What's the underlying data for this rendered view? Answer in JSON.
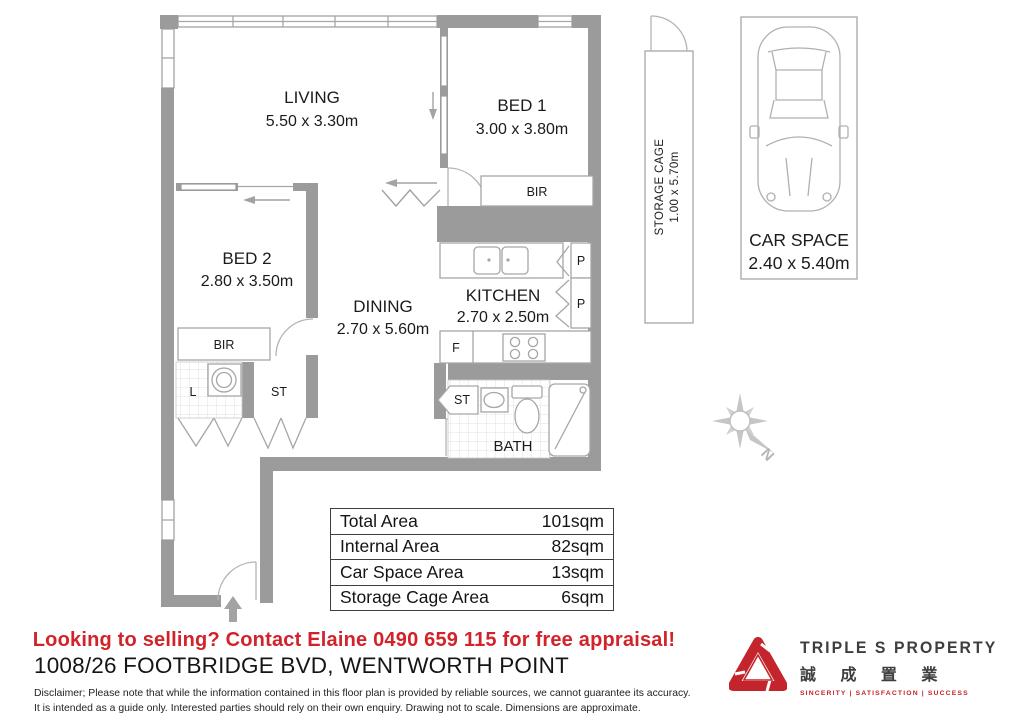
{
  "plan": {
    "rooms": {
      "living": {
        "name": "LIVING",
        "dims": "5.50 x 3.30m"
      },
      "bed1": {
        "name": "BED 1",
        "dims": "3.00 x 3.80m"
      },
      "bed2": {
        "name": "BED 2",
        "dims": "2.80 x 3.50m"
      },
      "dining": {
        "name": "DINING",
        "dims": "2.70 x 5.60m"
      },
      "kitchen": {
        "name": "KITCHEN",
        "dims": "2.70 x 2.50m"
      },
      "bath": {
        "name": "BATH"
      }
    },
    "fixtures": {
      "bir_bed1": "BIR",
      "bir_bed2": "BIR",
      "laundry": "L",
      "store_hall": "ST",
      "store_bath": "ST",
      "fridge": "F",
      "pantry_top": "P",
      "pantry_bottom": "P"
    },
    "compass": {
      "north": "N"
    },
    "storage_cage": {
      "label": "STORAGE CAGE",
      "dims": "1.00 x 5.70m"
    },
    "car_space": {
      "label": "CAR SPACE",
      "dims": "2.40 x 5.40m"
    }
  },
  "areas": {
    "rows": [
      {
        "label": "Total Area",
        "value": "101sqm"
      },
      {
        "label": "Internal Area",
        "value": "82sqm"
      },
      {
        "label": "Car Space Area",
        "value": "13sqm"
      },
      {
        "label": "Storage Cage Area",
        "value": "6sqm"
      }
    ]
  },
  "footer": {
    "promo": "Looking to selling? Contact Elaine 0490 659 115 for free appraisal!",
    "address": "1008/26 FOOTBRIDGE BVD, WENTWORTH POINT",
    "disclaimer1": "Disclaimer; Please note that while the information contained in this floor plan is provided by reliable sources, we cannot guarantee its accuracy.",
    "disclaimer2": "It is intended as a guide only. Interested parties should rely on their own enquiry. Drawing not to scale.  Dimensions are approximate."
  },
  "logo": {
    "title": "TRIPLE S PROPERTY",
    "chinese": "誠 成 置 業",
    "tagline": "SINCERITY   |   SATISFACTION   |   SUCCESS"
  },
  "colors": {
    "accent_red": "#d2232a",
    "wall_gray": "#9b9b9b",
    "logo_red": "#c4242b"
  }
}
